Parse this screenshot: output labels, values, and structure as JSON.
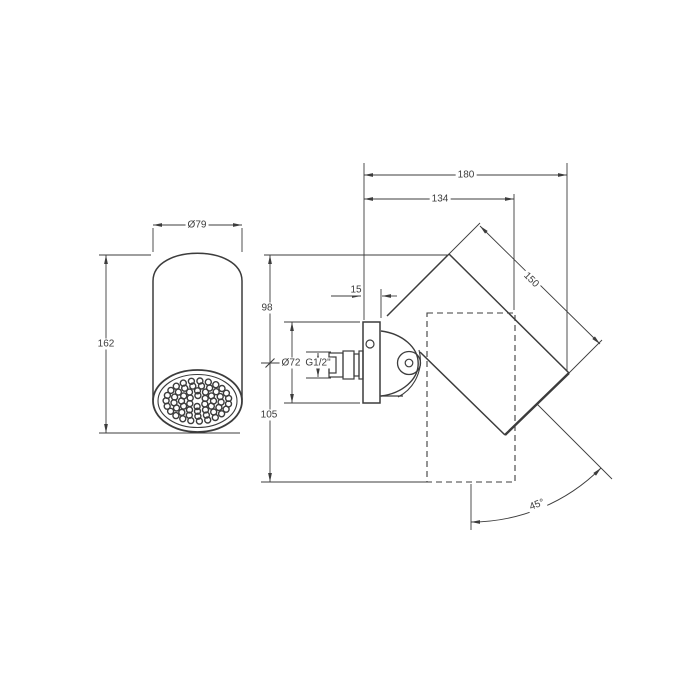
{
  "drawing": {
    "labels": {
      "head_diameter": "Ø79",
      "head_height": "162",
      "reach_total": "180",
      "reach_body": "134",
      "body_length": "150",
      "plate_thickness": "15",
      "height_above_axis": "98",
      "height_below_axis": "105",
      "plate_diameter": "Ø72",
      "thread_size": "G1/2\"",
      "swivel_angle": "45°"
    }
  }
}
